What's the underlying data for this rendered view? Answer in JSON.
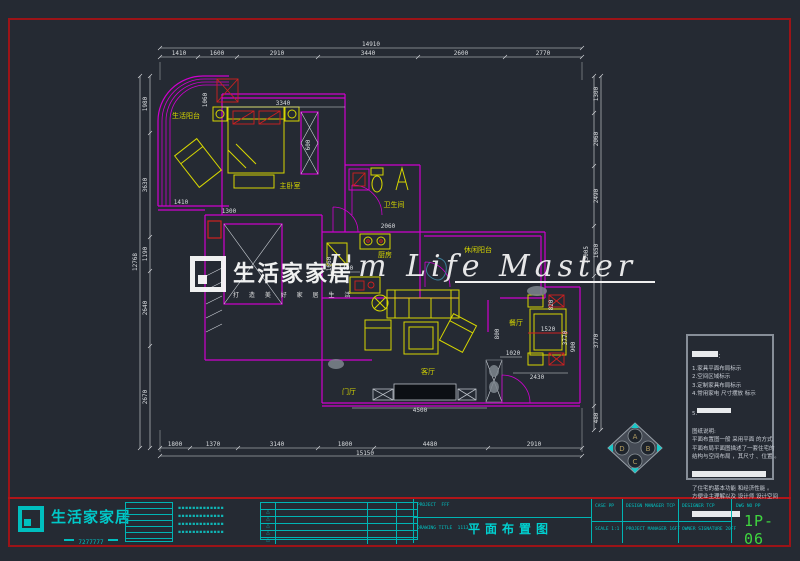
{
  "colors": {
    "background": "#252a33",
    "walls": "#cf00cf",
    "furniture": "#d6d600",
    "dimensions": "#dadde0",
    "frame_red": "#9c1317",
    "cyan": "#00bfbf",
    "accent_red": "#d02020",
    "drawing_number_green": "#3fd63f"
  },
  "rooms": {
    "living_balcony": "生活阳台",
    "master_bedroom": "主卧室",
    "bathroom": "卫生间",
    "kitchen": "厨房",
    "leisure_balcony": "休闲阳台",
    "dining_room": "餐厅",
    "living_room": "客厅",
    "foyer": "门厅"
  },
  "dims": {
    "top_total": "14910",
    "top_segments": [
      "1410",
      "1600",
      "2910",
      "3440",
      "2600",
      "2770"
    ],
    "bottom_total": "15150",
    "bottom_segments": [
      "1800",
      "1370",
      "3140",
      "1800",
      "4480",
      "2910"
    ],
    "left_total": "12768",
    "left_segments": [
      "1980",
      "3630",
      "1190",
      "2640",
      "2670"
    ],
    "right_total": "13005",
    "right_segments": [
      "1300",
      "2060",
      "2490",
      "1650",
      "3770",
      "480"
    ],
    "inner": {
      "bed_wall": "3340",
      "closet": "1060",
      "gap": "600",
      "balcony_opening": "1410",
      "hall": "1300",
      "kitchen_pass": "1490",
      "kitchen_depth": "1660",
      "counter": "2060",
      "dining_offset": "1020",
      "dining_width": "2430",
      "chair": "820",
      "pass": "800",
      "table": "900",
      "dining_height": "3770",
      "tv_wall": "4500",
      "table_len": "1520"
    }
  },
  "watermark": {
    "brand": "生活家家居",
    "tagline": "打 造 美 好 家 居 生 活",
    "script": "I'm Life Master"
  },
  "notes_panel": {
    "legend": [
      "1.家具平面布局标示",
      "2.空间区域标示",
      "3.定制家具布局标示",
      "4.常用家电 尺寸摆放 标示",
      "5."
    ],
    "description_title": "图纸说明:",
    "description": [
      "平面布置图一般 采用平面 的方式",
      "平面布局平面图描述了一套住宅的",
      "结构与空间布局 ，其尺寸 、位置 。",
      "了住宅的基本功能 和经济性能 。",
      "方便业主理解以及 设计师 设计空间"
    ]
  },
  "elevation_marker": {
    "letters": [
      "A",
      "B",
      "C",
      "D"
    ]
  },
  "title_block": {
    "brand": "生活家家居",
    "phone": "7277777",
    "mini_table_note": "▪▪▪▪▪",
    "company_info": [
      "▪▪▪▪▪▪▪▪▪▪▪▪▪",
      "▪▪▪▪▪▪▪▪▪▪▪▪▪",
      "▪▪▪▪▪▪▪▪▪▪▪▪▪",
      "▪▪▪▪▪▪▪▪▪▪▪▪▪"
    ],
    "revision_rows": [
      "△",
      "△",
      "△",
      "△",
      "△"
    ],
    "project_label": "PROJECT",
    "project_value": "FFF",
    "drawing_title_label": "DRAWING TITLE",
    "drawing_title_value": "1113",
    "drawing_title": "平面布置图",
    "case_label": "CASE",
    "case_value": "PP",
    "scale_label": "SCALE",
    "scale_value": "1:1",
    "design_manager_label": "DESIGN MANAGER",
    "design_manager_value": "TCP",
    "project_manager_label": "PROJECT MANAGER",
    "project_manager_value": "16FF",
    "designer_label": "DESIGNER",
    "designer_value": "TCP",
    "owner_label": "OWNER SIGNATURE",
    "owner_value": "20FF",
    "dwg_no_label": "DWG NO",
    "dwg_no_value": "PP",
    "drawing_number": "1P-06"
  }
}
